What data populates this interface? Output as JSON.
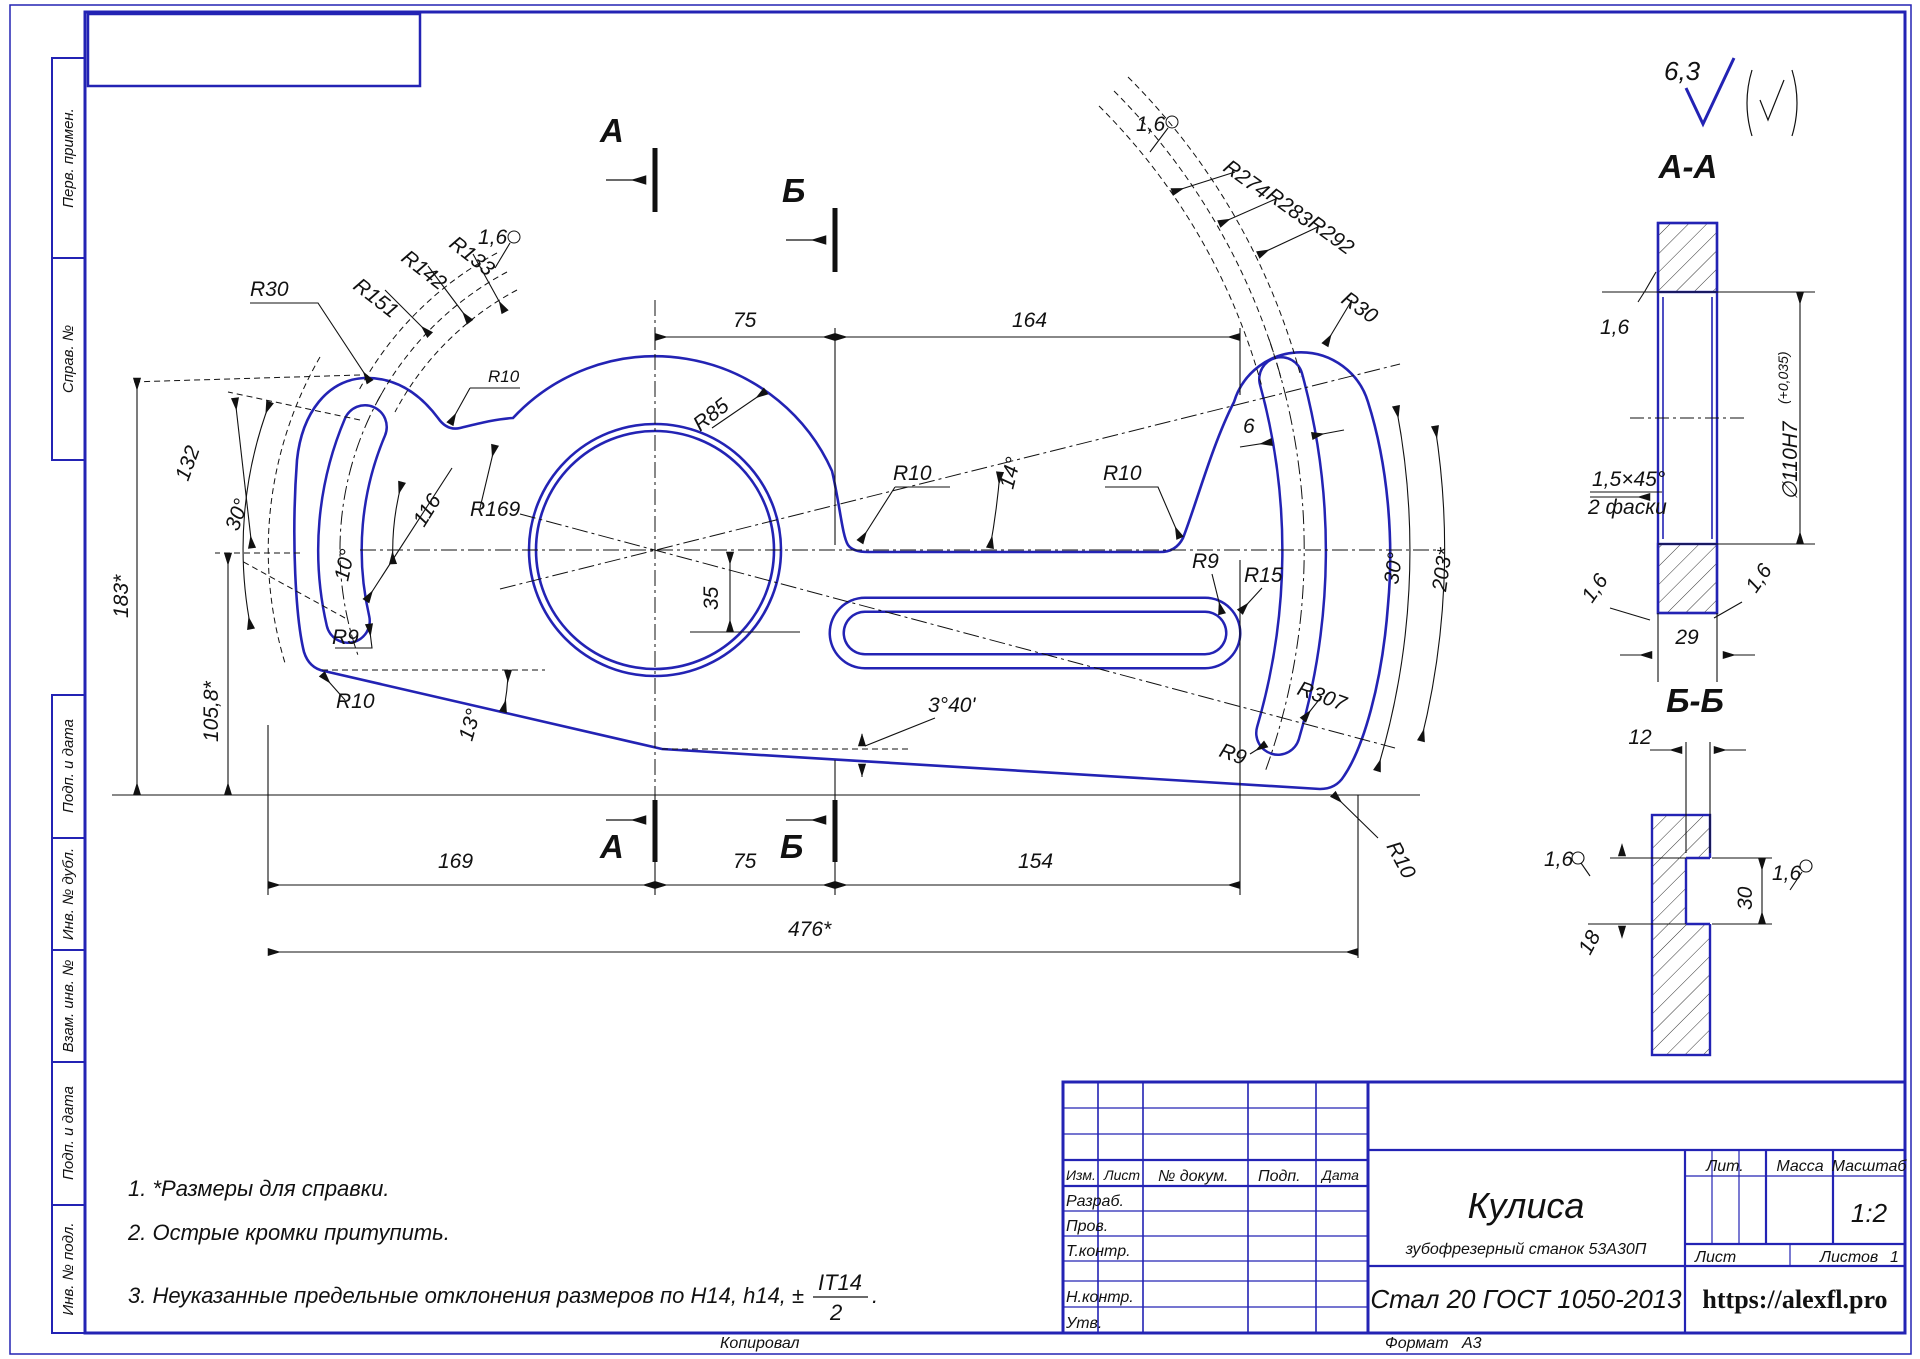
{
  "colors": {
    "line_blue": "#2323b4",
    "dim_black": "#111111",
    "paper": "#ffffff"
  },
  "margins": {
    "perv_primen": "Перв. примен.",
    "sprav_no": "Справ. №",
    "podp_data1": "Подп. и дата",
    "inv_dubl": "Инв. № дубл.",
    "vzam_inv": "Взам. инв. №",
    "podp_data2": "Подп. и дата",
    "inv_podl": "Инв. № подл."
  },
  "title_block": {
    "izm": "Изм.",
    "list": "Лист",
    "n_dokum": "№ докум.",
    "podp": "Подп.",
    "data": "Дата",
    "razrab": "Разраб.",
    "prov": "Пров.",
    "t_kontr": "Т.контр.",
    "n_kontr": "Н.контр.",
    "utv": "Утв.",
    "lit": "Лит.",
    "massa": "Масса",
    "masshtab": "Масштаб",
    "scale": "1:2",
    "list2": "Лист",
    "listov": "Листов",
    "listov_value": "1",
    "part_name": "Кулиса",
    "part_subtitle": "зубофрезерный станок 53А30П",
    "material": "Стал 20 ГОСТ 1050-2013",
    "site": "https://alexfl.pro",
    "copied": "Копировал",
    "format_label": "Формат",
    "format_value": "А3"
  },
  "notes": {
    "n1": "1.  *Размеры для справки.",
    "n2": "2.  Острые кромки притупить.",
    "n3": "3.  Неуказанные предельные отклонения размеров по H14, h14, ±",
    "frac_num": "IT14",
    "frac_den": "2",
    "n3_end": "."
  },
  "roughness": {
    "general": "6,3"
  },
  "mv": {
    "r30_left": "R30",
    "r151": "R151",
    "r142": "R142",
    "r133": "R133",
    "rough_left": "1,6",
    "r10_notch": "R10",
    "d75_top": "75",
    "d164": "164",
    "r274": "R274",
    "r283": "R283",
    "r292": "R292",
    "rough_right": "1,6",
    "r30_right": "R30",
    "r85": "R85",
    "r10_arm_left": "R10",
    "r10_arm_right": "R10",
    "a14": "14°",
    "d6": "6",
    "a30_right": "30°",
    "d203": "203*",
    "r169": "R169",
    "d132": "132",
    "a30_left": "30°",
    "a10": "10°",
    "d183": "183*",
    "d105": "105,8*",
    "r9_left": "R9",
    "d116": "116",
    "d35": "35",
    "r10_bl": "R10",
    "a13": "13°",
    "a340": "3°40'",
    "r9_mid": "R9",
    "r15": "R15",
    "r307": "R307",
    "r9_br": "R9",
    "r10_br": "R10",
    "d169": "169",
    "d75_bot": "75",
    "d154": "154",
    "d476": "476*",
    "sec_a": "А",
    "sec_b": "Б"
  },
  "aa": {
    "title": "А-А",
    "rough_top": "1,6",
    "dia": "∅110H7",
    "dia_tol": "(+0,035)",
    "chamfer": "1,5×45°",
    "chamfer2": "2 фаски",
    "rough_bl": "1,6",
    "rough_br": "1,6",
    "d29": "29"
  },
  "bb": {
    "title": "Б-Б",
    "d12": "12",
    "rough_left": "1,6",
    "d18": "18",
    "d30": "30",
    "rough_right": "1,6"
  }
}
